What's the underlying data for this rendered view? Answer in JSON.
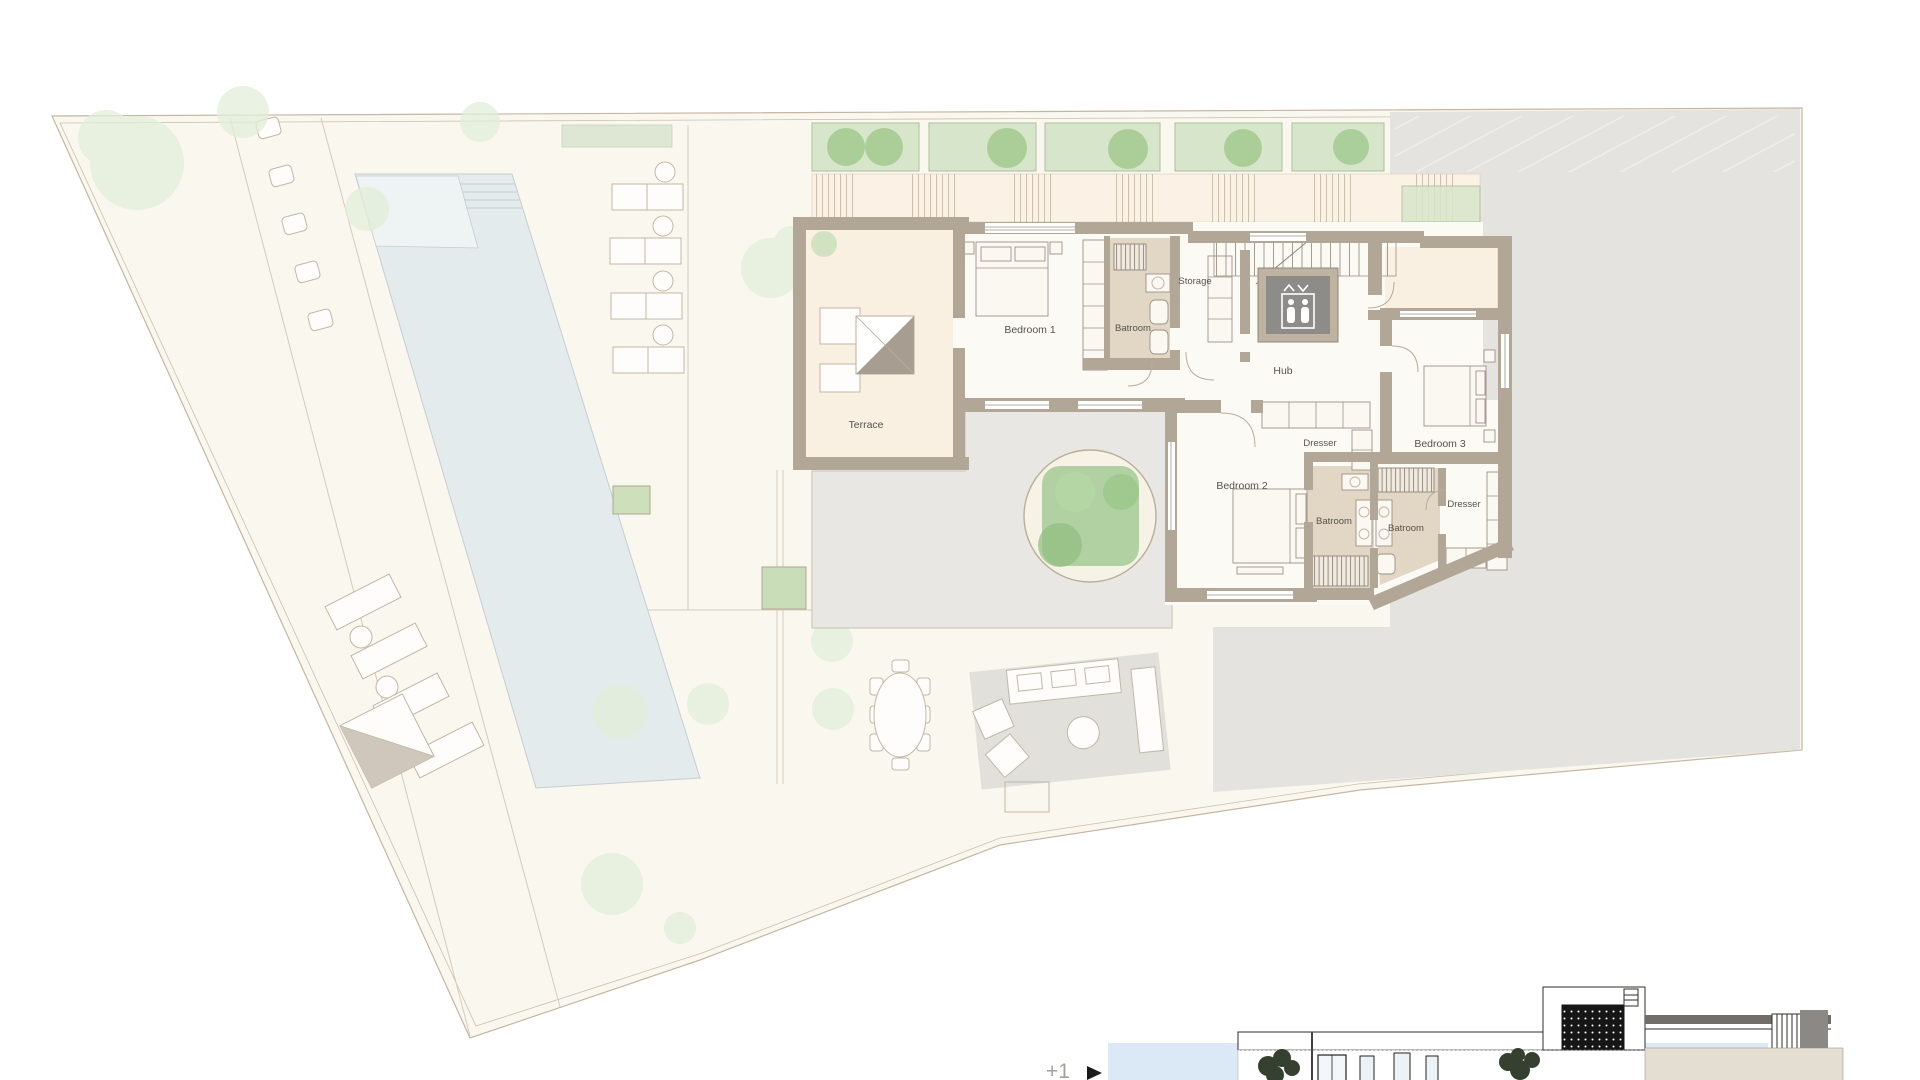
{
  "labels": {
    "terrace": "Terrace",
    "bedroom1": "Bedroom 1",
    "bathroom1": "Batroom",
    "storage": "Storage",
    "hub": "Hub",
    "dresser_hub": "Dresser",
    "bedroom2": "Bedroom 2",
    "bedroom3": "Bedroom 3",
    "bathroom2": "Batroom",
    "bathroom3": "Batroom",
    "dresser_bedroom3": "Dresser",
    "level": "+1"
  },
  "icons": {
    "level_marker": "right-triangle-marker",
    "elevator": "elevator-people-icon"
  },
  "colors": {
    "site_fill": "#FAF7EF",
    "boundary_line": "#C3B7A3",
    "wall": "#B2A696",
    "room_floor": "#FCFAF5",
    "terrace_floor": "#FAF0E2",
    "bath_floor": "#E2D6C5",
    "plaza": "#E9E7E3",
    "neighbor": "#E5E3DF",
    "pool": "#E3EBEC",
    "pool_shallow": "#EEF3F3",
    "planter_green": "#D7E6CA",
    "shrub_green": "#A9CD97",
    "tree_faint": "#E2EEDA",
    "elevator_cab": "#8E8C88",
    "elevator_frame": "#BFB4A2",
    "sky": "#DBE9F6",
    "facade_beige": "#E4DDD2",
    "label_text": "#56524B",
    "level_text": "#A2A09D"
  }
}
